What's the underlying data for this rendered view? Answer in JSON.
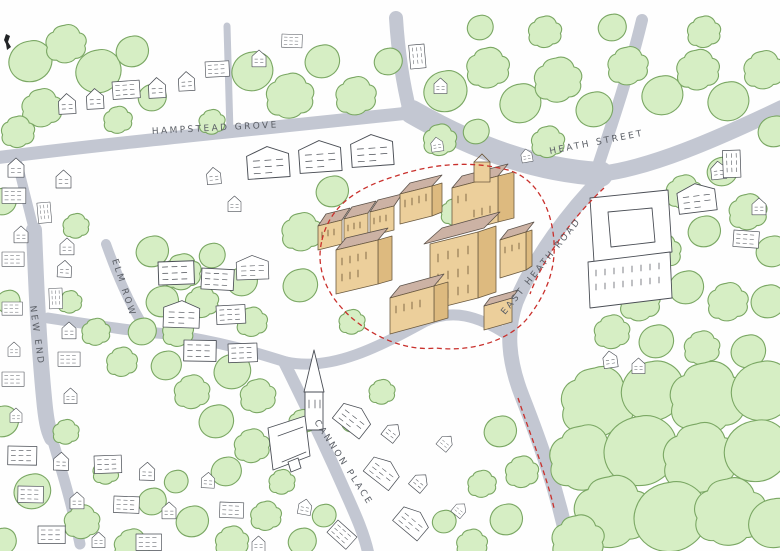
{
  "labels": {
    "hampstead_grove": "HAMPSTEAD GROVE",
    "heath_street": "HEATH STREET",
    "east_heath_road": "EAST HEATH ROAD",
    "elm_row": "ELM ROW",
    "new_end": "NEW END",
    "cannon_place": "CANNON PLACE"
  },
  "colors": {
    "paper": "#fefefe",
    "road": "#c3c7d2",
    "tree_fill": "#d6eec4",
    "tree_stroke": "#7aa763",
    "building_ink": "#4a4e55",
    "site_wall": "#eccf9b",
    "site_wall_shade": "#ddba7f",
    "site_roof": "#ccb2a4",
    "site_boundary_red": "#c9302c",
    "label_ink": "#5b5f66"
  }
}
